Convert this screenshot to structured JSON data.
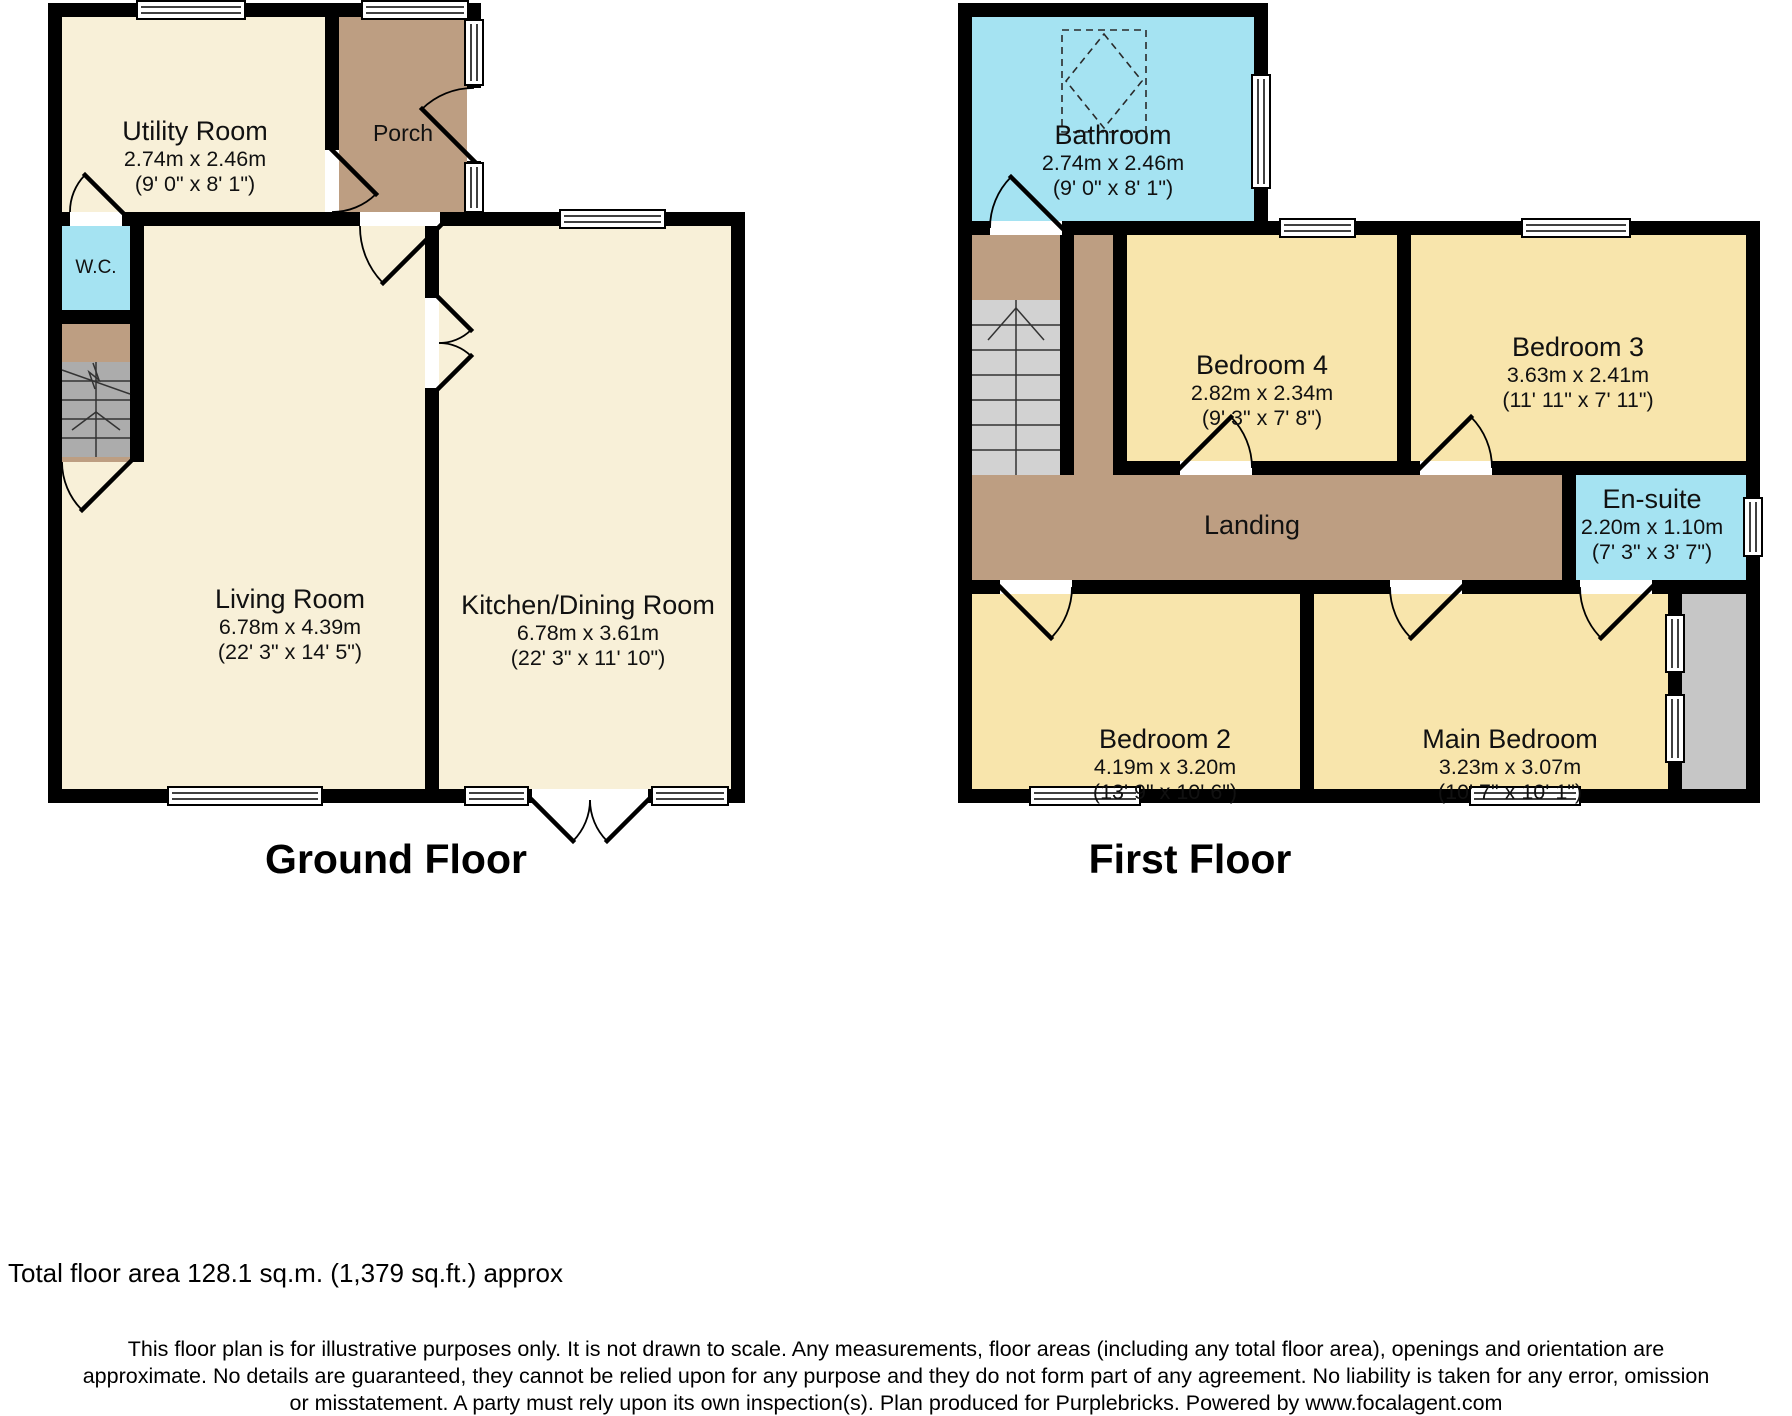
{
  "ground_floor": {
    "title": "Ground Floor",
    "rooms": [
      {
        "name": "Utility Room",
        "dims_m": "2.74m x 2.46m",
        "dims_ft": "(9' 0\" x 8' 1\")"
      },
      {
        "name": "Porch"
      },
      {
        "name": "W.C."
      },
      {
        "name": "Living Room",
        "dims_m": "6.78m x 4.39m",
        "dims_ft": "(22' 3\" x 14' 5\")"
      },
      {
        "name": "Kitchen/Dining Room",
        "dims_m": "6.78m x 3.61m",
        "dims_ft": "(22' 3\" x 11' 10\")"
      }
    ]
  },
  "first_floor": {
    "title": "First Floor",
    "rooms": [
      {
        "name": "Bathroom",
        "dims_m": "2.74m x 2.46m",
        "dims_ft": "(9' 0\" x 8' 1\")"
      },
      {
        "name": "Bedroom 4",
        "dims_m": "2.82m x 2.34m",
        "dims_ft": "(9' 3\" x 7' 8\")"
      },
      {
        "name": "Bedroom 3",
        "dims_m": "3.63m x 2.41m",
        "dims_ft": "(11' 11\" x 7' 11\")"
      },
      {
        "name": "En-suite",
        "dims_m": "2.20m x 1.10m",
        "dims_ft": "(7' 3\" x 3' 7\")"
      },
      {
        "name": "Landing"
      },
      {
        "name": "Bedroom 2",
        "dims_m": "4.19m x 3.20m",
        "dims_ft": "(13' 9\" x 10' 6\")"
      },
      {
        "name": "Main Bedroom",
        "dims_m": "3.23m x 3.07m",
        "dims_ft": "(10' 7\" x 10' 1\")"
      }
    ]
  },
  "footer": {
    "total_area": "Total floor area 128.1 sq.m. (1,379 sq.ft.) approx",
    "disclaimer_lines": [
      "This floor plan is for illustrative purposes only. It is not drawn to scale. Any measurements, floor areas (including any total floor area), openings and orientation are",
      "approximate. No details are guaranteed, they cannot be relied upon for any purpose and they do not form part of any agreement. No liability is taken for any error, omission",
      "or misstatement. A party must rely upon its own inspection(s). Plan produced for Purplebricks. Powered by www.focalagent.com"
    ]
  },
  "colors": {
    "wall": "#000000",
    "ground_room": "#F8F0D8",
    "bedroom": "#F8E5AC",
    "hall_tan": "#BD9E82",
    "wet_room_blue": "#A5E3F2",
    "stairs_gray": "#ACACAC",
    "stairs_gray_light": "#D2D2D2",
    "exterior_gray": "#C6C6C6"
  }
}
